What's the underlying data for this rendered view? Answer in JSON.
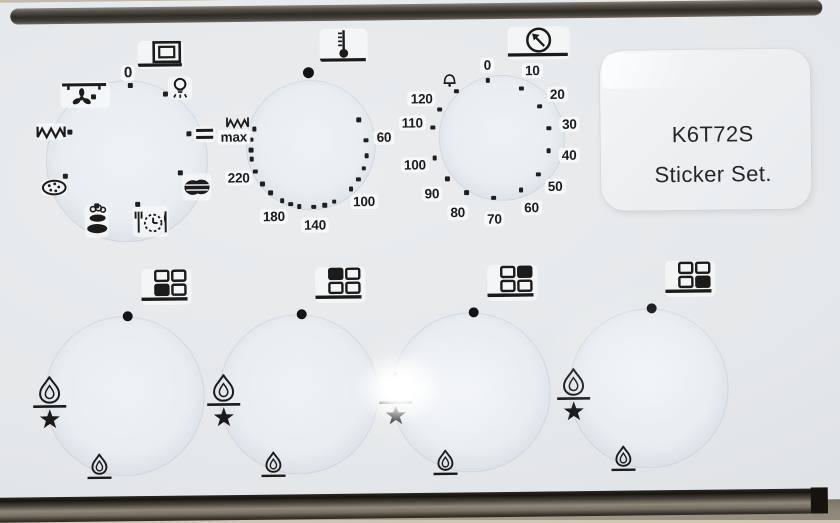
{
  "colors": {
    "ink": "#1b1b1b",
    "sheet": "#e6e9eb",
    "table_background": "#c7bead",
    "metal_trim": "#3a352e",
    "label_text": "#26262a"
  },
  "label_sticker": {
    "line1": "K6T72S",
    "line2": "Sticker Set."
  },
  "oven_function_dial": {
    "header_icon": "oven-box-icon",
    "off_label": "0",
    "positions": [
      {
        "icon": "fan-upper-heat-icon"
      },
      {
        "icon": "oven-lamp-icon"
      },
      {
        "icon": "upper-lower-heat-icon"
      },
      {
        "icon": "roast-icon"
      },
      {
        "icon": "auto-cook-timer-icon"
      },
      {
        "icon": "casserole-icon"
      },
      {
        "icon": "pizza-icon"
      },
      {
        "icon": "grill-element-icon"
      }
    ]
  },
  "thermostat_dial": {
    "header_icon": "thermometer-icon",
    "off_position": "dot",
    "max_heat_icon": "grill-element-icon",
    "label_radius": 76,
    "tick_radius": 58,
    "labels": [
      {
        "text": "60",
        "angle": 82
      },
      {
        "text": "100",
        "angle": 134
      },
      {
        "text": "140",
        "angle": 176
      },
      {
        "text": "180",
        "angle": 208
      },
      {
        "text": "220",
        "angle": 248
      },
      {
        "text": "max",
        "angle": 280
      }
    ],
    "tick_angles": [
      60,
      82,
      97,
      110,
      122,
      134,
      155,
      165,
      176,
      190,
      199,
      208,
      222,
      234,
      248,
      261,
      270,
      280,
      291
    ]
  },
  "timer_dial": {
    "header_icon": "minute-timer-icon",
    "bell_icon": "bell-icon",
    "label_radius": 80,
    "tick_radius": 59,
    "labels": [
      {
        "text": "0",
        "angle": -2,
        "r": 74
      },
      {
        "text": "10",
        "angle": 32
      },
      {
        "text": "20",
        "angle": 57
      },
      {
        "text": "30",
        "angle": 80
      },
      {
        "text": "40",
        "angle": 102
      },
      {
        "text": "50",
        "angle": 127
      },
      {
        "text": "60",
        "angle": 150
      },
      {
        "text": "70",
        "angle": 178
      },
      {
        "text": "80",
        "angle": 205
      },
      {
        "text": "90",
        "angle": 228
      },
      {
        "text": "100",
        "angle": 252
      },
      {
        "text": "110",
        "angle": 282
      },
      {
        "text": "120",
        "angle": 301
      }
    ],
    "tick_angles": [
      -2,
      32,
      57,
      80,
      102,
      127,
      150,
      178,
      205,
      228,
      252,
      282,
      301,
      325
    ]
  },
  "burner_dials": [
    {
      "filled_cell": "bottom-left"
    },
    {
      "filled_cell": "top-left"
    },
    {
      "filled_cell": "top-right"
    },
    {
      "filled_cell": "bottom-right"
    }
  ],
  "burner_symbols": {
    "left": "large-flame-with-ignition-star",
    "bottom": "small-flame",
    "top": "off-dot"
  }
}
